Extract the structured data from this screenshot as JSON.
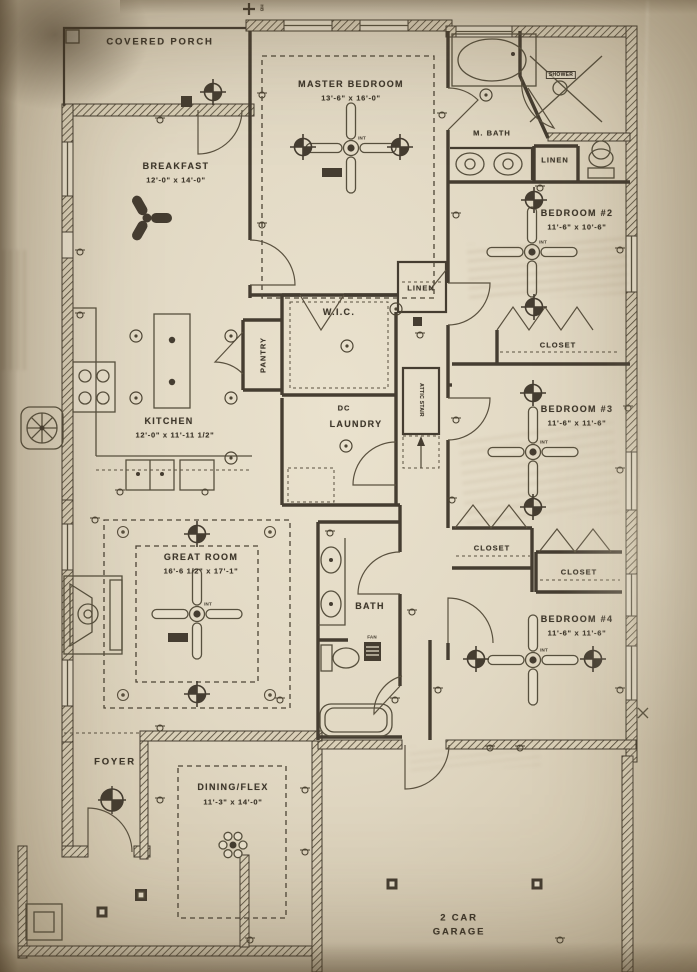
{
  "drawing": {
    "type": "residential floor plan (electrical/ceiling plan)",
    "paper_color": "#e1d8c3",
    "ink_color": "#453d31"
  },
  "rooms": {
    "covered_porch": {
      "name": "COVERED PORCH"
    },
    "master_bedroom": {
      "name": "MASTER BEDROOM",
      "dims": "13'-6\" x 16'-0\""
    },
    "m_bath": {
      "name": "M. BATH"
    },
    "shower": {
      "name": "SHOWER"
    },
    "linen_master": {
      "name": "LINEN"
    },
    "linen_hall": {
      "name": "LINEN"
    },
    "bedroom_2": {
      "name": "BEDROOM #2",
      "dims": "11'-6\" x 10'-6\""
    },
    "breakfast": {
      "name": "BREAKFAST",
      "dims": "12'-0\" x 14'-0\""
    },
    "wic": {
      "name": "W.I.C."
    },
    "pantry": {
      "name": "PANTRY"
    },
    "kitchen": {
      "name": "KITCHEN",
      "dims": "12'-0\" x 11'-11 1/2\""
    },
    "dc": {
      "name": "DC"
    },
    "laundry": {
      "name": "LAUNDRY"
    },
    "attic_stair": {
      "name": "ATTIC STAIR"
    },
    "closet_bed2": {
      "name": "CLOSET"
    },
    "bedroom_3": {
      "name": "BEDROOM #3",
      "dims": "11'-6\" x 11'-6\""
    },
    "closet_left": {
      "name": "CLOSET"
    },
    "closet_right": {
      "name": "CLOSET"
    },
    "great_room": {
      "name": "GREAT ROOM",
      "dims": "16'-6 1/2\" x 17'-1\""
    },
    "bath": {
      "name": "BATH"
    },
    "bedroom_4": {
      "name": "BEDROOM #4",
      "dims": "11'-6\" x 11'-6\""
    },
    "foyer": {
      "name": "FOYER"
    },
    "dining_flex": {
      "name": "DINING/FLEX",
      "dims": "11'-3\" x 14'-0\""
    },
    "garage": {
      "line1": "2 CAR",
      "line2": "GARAGE"
    }
  },
  "annotations": {
    "hose_bib": "HB",
    "fan_tag": "INT",
    "fan_note": "FAN"
  }
}
